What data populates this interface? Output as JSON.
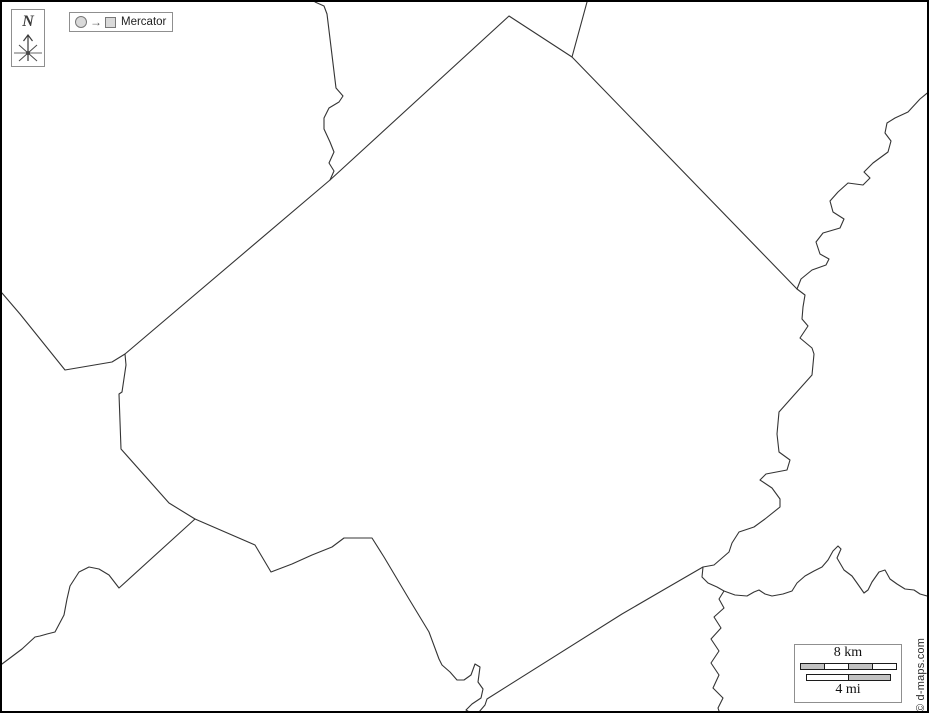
{
  "compass": {
    "label": "N"
  },
  "projection_button": {
    "label": "Mercator"
  },
  "scale_bar": {
    "km_label": "8 km",
    "mi_label": "4 mi"
  },
  "credit": "© d-maps.com",
  "colors": {
    "line": "#343434",
    "frame_border": "#000000",
    "box_border": "#8f8f8f",
    "bar_gray": "#c2c2c2",
    "bar_border": "#1c1c1c",
    "icon_fill": "#d9d9d9",
    "icon_border": "#787878",
    "text": "#1f1f1f"
  },
  "map": {
    "paths": [
      {
        "name": "county-outline",
        "points": [
          [
            123,
            352
          ],
          [
            328,
            178
          ],
          [
            507,
            14
          ],
          [
            570,
            55
          ],
          [
            795,
            287
          ],
          [
            803,
            293
          ],
          [
            801,
            305
          ],
          [
            800,
            317
          ],
          [
            806,
            324
          ],
          [
            798,
            336
          ],
          [
            810,
            346
          ],
          [
            812,
            352
          ],
          [
            810,
            373
          ],
          [
            793,
            392
          ],
          [
            777,
            410
          ],
          [
            775,
            432
          ],
          [
            777,
            450
          ],
          [
            788,
            458
          ],
          [
            785,
            468
          ],
          [
            764,
            472
          ],
          [
            758,
            478
          ],
          [
            770,
            486
          ],
          [
            778,
            497
          ],
          [
            778,
            505
          ],
          [
            763,
            517
          ],
          [
            752,
            525
          ],
          [
            737,
            530
          ],
          [
            730,
            541
          ],
          [
            727,
            550
          ],
          [
            712,
            563
          ],
          [
            701,
            565
          ],
          [
            663,
            587
          ],
          [
            620,
            612
          ],
          [
            485,
            697
          ],
          [
            483,
            703
          ],
          [
            477,
            710
          ],
          [
            469,
            711
          ],
          [
            464,
            708
          ],
          [
            470,
            702
          ],
          [
            479,
            696
          ],
          [
            481,
            687
          ],
          [
            476,
            680
          ],
          [
            478,
            665
          ],
          [
            473,
            662
          ],
          [
            469,
            673
          ],
          [
            462,
            678
          ],
          [
            455,
            678
          ],
          [
            448,
            670
          ],
          [
            440,
            663
          ],
          [
            437,
            657
          ],
          [
            427,
            630
          ],
          [
            407,
            597
          ],
          [
            382,
            555
          ],
          [
            370,
            536
          ],
          [
            342,
            536
          ],
          [
            330,
            545
          ],
          [
            310,
            553
          ],
          [
            290,
            562
          ],
          [
            269,
            570
          ],
          [
            253,
            543
          ],
          [
            193,
            517
          ],
          [
            167,
            501
          ],
          [
            119,
            447
          ],
          [
            117,
            392
          ],
          [
            120,
            390
          ],
          [
            124,
            363
          ],
          [
            123,
            352
          ]
        ]
      },
      {
        "name": "river-upper",
        "points": [
          [
            929,
            88
          ],
          [
            918,
            97
          ],
          [
            906,
            110
          ],
          [
            893,
            116
          ],
          [
            885,
            121
          ],
          [
            883,
            131
          ],
          [
            889,
            139
          ],
          [
            886,
            150
          ],
          [
            871,
            161
          ],
          [
            862,
            170
          ],
          [
            868,
            176
          ],
          [
            861,
            183
          ],
          [
            846,
            181
          ],
          [
            836,
            190
          ],
          [
            828,
            199
          ],
          [
            831,
            210
          ],
          [
            842,
            217
          ],
          [
            838,
            226
          ],
          [
            821,
            231
          ],
          [
            814,
            240
          ],
          [
            818,
            252
          ],
          [
            827,
            257
          ],
          [
            824,
            263
          ],
          [
            810,
            268
          ],
          [
            799,
            277
          ],
          [
            795,
            287
          ]
        ]
      },
      {
        "name": "river-lower",
        "points": [
          [
            701,
            565
          ],
          [
            700,
            575
          ],
          [
            706,
            581
          ],
          [
            715,
            585
          ],
          [
            722,
            589
          ],
          [
            717,
            597
          ],
          [
            722,
            606
          ],
          [
            712,
            615
          ],
          [
            719,
            626
          ],
          [
            709,
            637
          ],
          [
            717,
            649
          ],
          [
            709,
            661
          ],
          [
            717,
            673
          ],
          [
            711,
            686
          ],
          [
            721,
            696
          ],
          [
            716,
            706
          ],
          [
            718,
            712
          ]
        ]
      },
      {
        "name": "river-tributary-east",
        "points": [
          [
            722,
            589
          ],
          [
            733,
            593
          ],
          [
            745,
            594
          ],
          [
            752,
            590
          ],
          [
            757,
            588
          ],
          [
            763,
            592
          ],
          [
            770,
            594
          ],
          [
            781,
            592
          ],
          [
            790,
            589
          ],
          [
            795,
            581
          ],
          [
            803,
            574
          ],
          [
            812,
            569
          ],
          [
            820,
            565
          ],
          [
            826,
            558
          ],
          [
            831,
            549
          ],
          [
            836,
            544
          ],
          [
            839,
            547
          ],
          [
            835,
            556
          ],
          [
            842,
            568
          ],
          [
            850,
            574
          ],
          [
            855,
            581
          ],
          [
            862,
            591
          ],
          [
            866,
            588
          ],
          [
            870,
            580
          ],
          [
            877,
            570
          ],
          [
            883,
            568
          ],
          [
            888,
            577
          ],
          [
            895,
            582
          ],
          [
            903,
            587
          ],
          [
            912,
            588
          ],
          [
            918,
            592
          ],
          [
            925,
            594
          ],
          [
            929,
            593
          ]
        ]
      },
      {
        "name": "boundary-north-neighbor",
        "points": [
          [
            313,
            0
          ],
          [
            322,
            4
          ],
          [
            325,
            12
          ],
          [
            334,
            86
          ],
          [
            341,
            94
          ],
          [
            337,
            100
          ],
          [
            327,
            106
          ],
          [
            322,
            116
          ],
          [
            322,
            127
          ],
          [
            328,
            140
          ],
          [
            332,
            150
          ],
          [
            327,
            161
          ],
          [
            332,
            169
          ],
          [
            328,
            178
          ]
        ]
      },
      {
        "name": "boundary-northeast-neighbor",
        "points": [
          [
            585,
            0
          ],
          [
            570,
            55
          ]
        ]
      },
      {
        "name": "boundary-west-neighbor",
        "points": [
          [
            0,
            291
          ],
          [
            18,
            312
          ],
          [
            63,
            368
          ],
          [
            110,
            360
          ],
          [
            123,
            352
          ]
        ]
      },
      {
        "name": "boundary-southwest-neighbor",
        "points": [
          [
            193,
            517
          ],
          [
            117,
            586
          ],
          [
            107,
            573
          ],
          [
            97,
            567
          ],
          [
            87,
            565
          ],
          [
            77,
            570
          ],
          [
            68,
            584
          ],
          [
            65,
            597
          ],
          [
            62,
            613
          ],
          [
            53,
            630
          ],
          [
            45,
            632
          ],
          [
            38,
            634
          ],
          [
            33,
            635
          ],
          [
            20,
            647
          ],
          [
            8,
            656
          ],
          [
            0,
            662
          ]
        ]
      }
    ]
  }
}
